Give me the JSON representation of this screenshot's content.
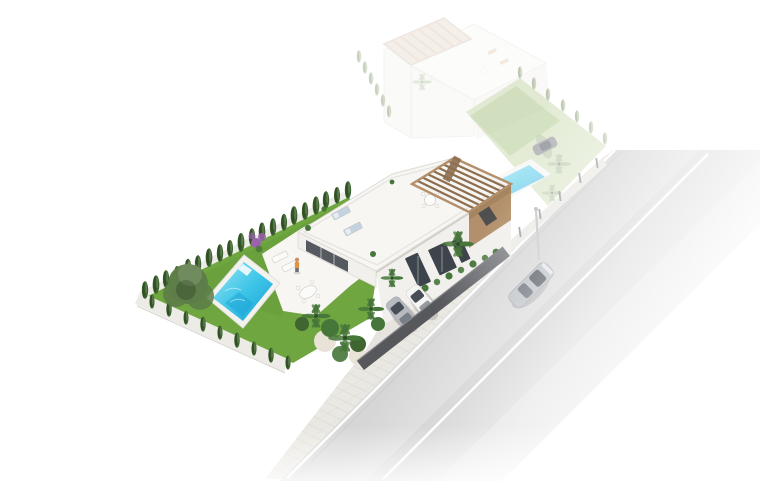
{
  "scene": {
    "alt": "Aerial 3D architectural rendering of a modern white single-family villa on a corner plot with rooftop solarium, wooden pergola, turquoise swimming pool, green lawn with cypress hedge, sun loungers, outdoor dining set, tropical garden, driveway with two parked cars behind a dark fence, a sidewalk, a road with a silver car driving by, and a faded neighboring villa with its own pool and parked car in the background",
    "objects": [
      "ghost-villa",
      "ghost-pergola",
      "ghost-roof-terrace",
      "ghost-pool",
      "ghost-lawn",
      "ghost-parked-car",
      "ghost-palm-trees",
      "ghost-hedges",
      "boundary-wall-with-posts",
      "street-lamp",
      "main-villa",
      "rooftop-solarium",
      "rooftop-loungers",
      "wood-pergola",
      "pergola-dining-table",
      "brown-accent-wall",
      "facade-doors",
      "facade-palm",
      "terrace",
      "terrace-loungers",
      "standing-person",
      "terrace-dining-table",
      "swimming-pool",
      "pool-deck",
      "lawn",
      "olive-tree",
      "bougainvillea-bush",
      "cypress-hedge",
      "garden-wall",
      "tropical-garden",
      "driveway",
      "parked-white-car",
      "parked-silver-car",
      "street-fence",
      "sidewalk",
      "road",
      "road-lane-line",
      "driving-silver-car"
    ],
    "palette": {
      "bg": "#ffffff",
      "roof_white": "#f7f6f3",
      "wall_white": "#f1f0ec",
      "wall_out": "#ecebe6",
      "wall_shade": "#dfdcd6",
      "outline": "#dcdad4",
      "glass": "#3e444b",
      "pergola_wood": "#b3906b",
      "pergola_wood_dark": "#8d6e4f",
      "ghost_wood": "#ddc6b5",
      "ghost_wood_dark": "#cbae99",
      "pool_light": "#9fe6f5",
      "pool_mid": "#3fc6e8",
      "pool_deep": "#18a0d4",
      "pool_deck": "#f3f2ee",
      "lawn": "#6fa63f",
      "lawn_dark": "#5e9434",
      "lawn_pale": "#ccdcb2",
      "cypress": "#2d4b26",
      "cypress_mid": "#3f6630",
      "cypress_pale": "#a9bd92",
      "olive": "#5d7d49",
      "palm": "#47763a",
      "palm_pale": "#9cb489",
      "bougainvillea": "#9a63ac",
      "fence": "#56585c",
      "fence_light": "#83858a",
      "sidewalk": "#eae8e2",
      "sidewalk_line": "#d9d6cf",
      "road": "#d6d6d6",
      "road_dark": "#c6c6c6",
      "lane": "#ffffff",
      "car_white": "#f5f5f4",
      "car_silver": "#b7bbc1",
      "car_dark": "#787d84",
      "car_glass": "#474e57",
      "skin": "#cf8b5d",
      "shirt": "#e09440",
      "sand": "#e9e3d7",
      "lounger_white": "#fafaf8",
      "lounger_blue": "#c3d2de"
    }
  }
}
